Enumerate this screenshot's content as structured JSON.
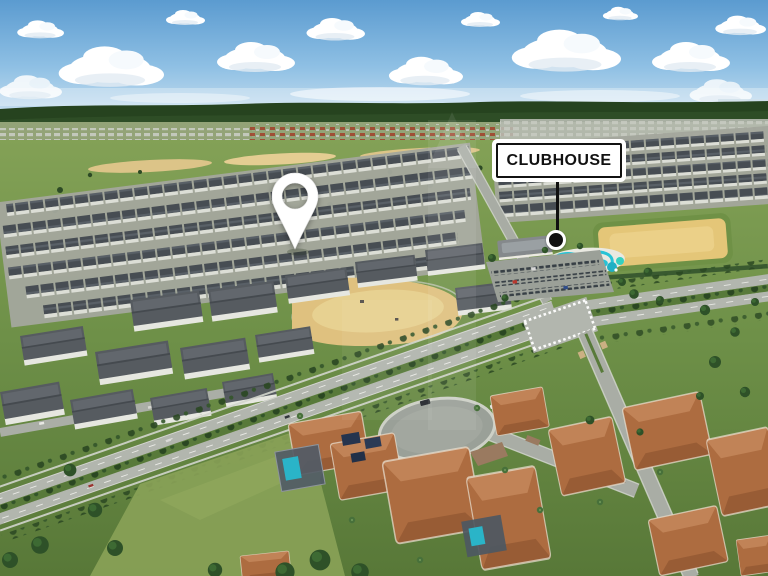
{
  "annotation": {
    "label": "CLUBHOUSE"
  },
  "icons": {
    "marker": "map-pin",
    "location": "location-dot"
  },
  "scene": {
    "type": "aerial-drone-photo",
    "subject": "residential community with townhome rows, clubhouse pool area, sand lots, boulevard and cul-de-sac homes"
  },
  "colors": {
    "sky_top": "#5b9bd0",
    "sky_horizon": "#cfe3f1",
    "cloud": "#ffffff",
    "treeline": "#26431f",
    "field_green": "#7f9e54",
    "grass_dark": "#5e7e3e",
    "sand": "#e0c27d",
    "townhouse_roof": "#474d53",
    "townhouse_wall": "#dcded6",
    "road": "#b2b6ae",
    "median_green": "#587a3a",
    "pool_teal": "#2cc5d8",
    "terracotta_roof": "#ad6c40",
    "label_background": "#ffffff",
    "label_border": "#111111",
    "label_text": "#111111",
    "pin_white": "#ffffff",
    "marker_dot": "#111111"
  }
}
